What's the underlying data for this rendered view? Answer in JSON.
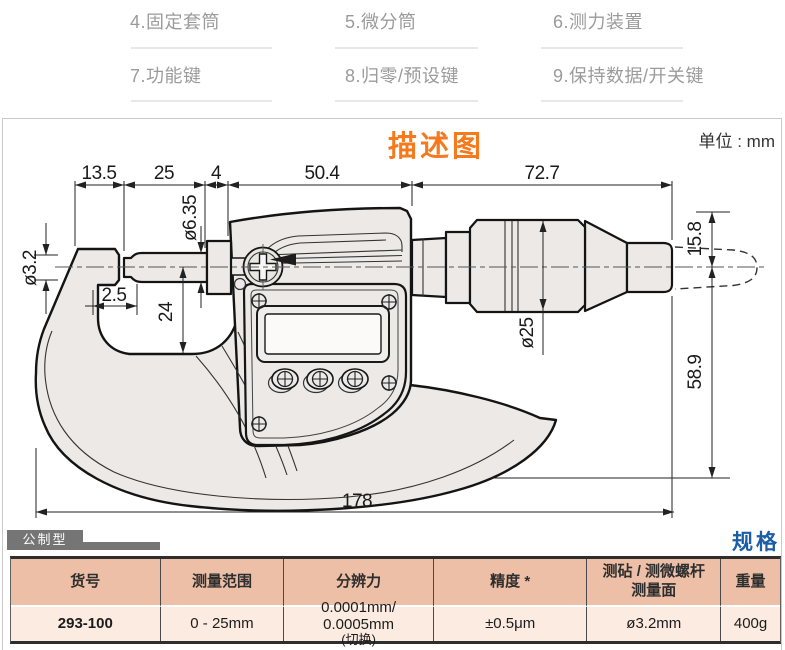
{
  "callouts": {
    "c4": "4.固定套筒",
    "c5": "5.微分筒",
    "c6": "6.测力装置",
    "c7": "7.功能键",
    "c8": "8.归零/预设键",
    "c9": "9.保持数据/开关键"
  },
  "diagram": {
    "title": "描述图",
    "unit": "单位 : mm",
    "dims": {
      "d13_5": "13.5",
      "d25": "25",
      "d4": "4",
      "d50_4": "50.4",
      "d72_7": "72.7",
      "d3_2": "ø3.2",
      "d6_35": "ø6.35",
      "d2_5": "2.5",
      "d24": "24",
      "dia25": "ø25",
      "d15_8": "15.8",
      "d58_9": "58.9",
      "d178": "178"
    }
  },
  "spec": {
    "tab": "公制型",
    "title": "规格",
    "headers": {
      "h1": "货号",
      "h2": "测量范围",
      "h3": "分辨力",
      "h4": "精度 *",
      "h5a": "测砧 / 测微螺杆",
      "h5b": "测量面",
      "h6": "重量"
    },
    "row": {
      "code": "293-100",
      "range": "0 - 25mm",
      "res1": "0.0001mm/ 0.0005mm",
      "res2": "(切换)",
      "accuracy": "±0.5μm",
      "face": "ø3.2mm",
      "weight": "400g"
    }
  },
  "colors": {
    "accent_orange": "#f5791d",
    "spec_blue": "#1b5ea6",
    "table_header_bg": "#ecbfa6",
    "table_row_bg": "#fcebe0",
    "tab_gray": "#757575"
  }
}
